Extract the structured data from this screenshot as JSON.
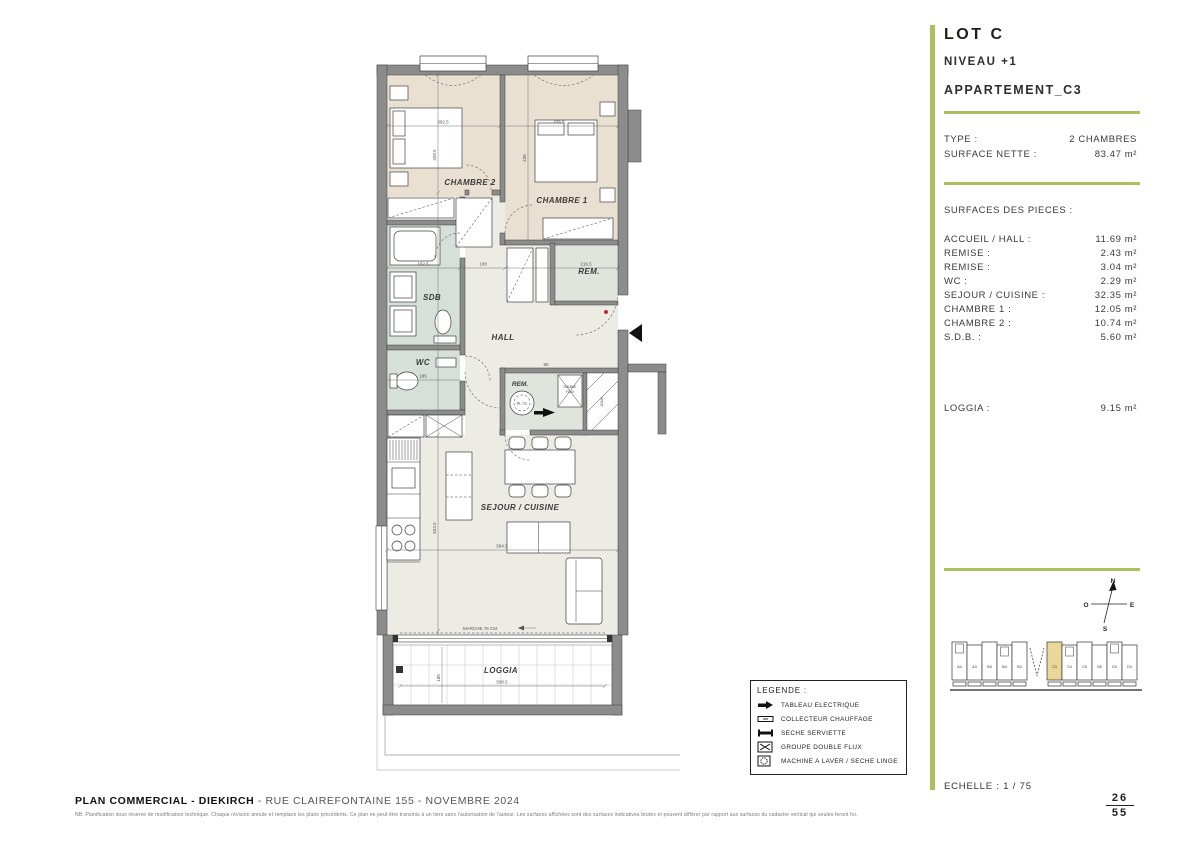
{
  "header": {
    "lot": "LOT C",
    "niveau": "NIVEAU +1",
    "apartment": "APPARTEMENT_C3"
  },
  "summary": {
    "type_label": "TYPE :",
    "type_value": "2 CHAMBRES",
    "surface_label": "SURFACE NETTE :",
    "surface_value": "83.47 m²",
    "pieces_header": "SURFACES DES PIECES :"
  },
  "rooms": [
    {
      "label": "ACCUEIL / HALL :",
      "value": "11.69 m²"
    },
    {
      "label": "REMISE :",
      "value": "2.43 m²"
    },
    {
      "label": "REMISE :",
      "value": "3.04 m²"
    },
    {
      "label": "WC :",
      "value": "2.29 m²"
    },
    {
      "label": "SEJOUR / CUISINE :",
      "value": "32.35 m²"
    },
    {
      "label": "CHAMBRE 1 :",
      "value": "12.05 m²"
    },
    {
      "label": "CHAMBRE 2 :",
      "value": "10.74 m²"
    },
    {
      "label": "S.D.B. :",
      "value": "5.60 m²"
    }
  ],
  "loggia_row": {
    "label": "LOGGIA :",
    "value": "9.15 m²"
  },
  "scale": "ECHELLE : 1 / 75",
  "page": {
    "current": "26",
    "total": "55"
  },
  "plan": {
    "labels": {
      "chambre2": "CHAMBRE 2",
      "chambre1": "CHAMBRE 1",
      "sdb": "SDB",
      "wc": "WC",
      "hall": "HALL",
      "rem1": "REM.",
      "rem2": "REM.",
      "sejour": "SEJOUR / CUISINE",
      "loggia": "LOGGIA",
      "marche": "MARCHE 76 CM",
      "ml": "ML / SL",
      "df1": "DOUBLE",
      "df2": "FLUX",
      "shaft": "40/126"
    },
    "dims": {
      "chambre2_w": "302.5",
      "chambre1_w": "276.5",
      "chambre2_h": "328.5",
      "chambre1_h": "436",
      "sdb_w": "182.5",
      "hall_w": "108",
      "rem1_w": "216.5",
      "wc_w": "185",
      "rem2_w": "95",
      "sejour_h": "553.5",
      "sejour_w": "584.5",
      "loggia_w": "508.5",
      "loggia_h": "180"
    }
  },
  "legend": {
    "title": "LEGENDE :",
    "items": [
      {
        "icon": "tableau-electrique-icon",
        "label": "TABLEAU ELECTRIQUE"
      },
      {
        "icon": "collecteur-chauffage-icon",
        "label": "COLLECTEUR CHAUFFAGE"
      },
      {
        "icon": "seche-serviette-icon",
        "label": "SECHE SERVIETTE"
      },
      {
        "icon": "groupe-double-flux-icon",
        "label": "GROUPE DOUBLE FLUX"
      },
      {
        "icon": "machine-a-laver-icon",
        "label": "MACHINE A LAVER / SECHE LINGE"
      }
    ]
  },
  "compass": {
    "n": "N",
    "e": "E",
    "s": "S",
    "o": "O"
  },
  "position_diagram": {
    "units": [
      "A4",
      "A3",
      "B5",
      "B4",
      "B3",
      "C3",
      "C4",
      "C5",
      "D5",
      "D4",
      "D3"
    ],
    "highlighted": "C3"
  },
  "footer": {
    "title_bold": "PLAN COMMERCIAL - DIEKIRCH",
    "title_rest": " - RUE CLAIREFONTAINE 155 - NOVEMBRE 2024",
    "disclaimer": "NB: Planification sous réserve de modification technique. Chaque révision annule et remplace les plans précédents. Ce plan ne peut être transmis à un tiers sans l'autorisation de l'auteur. Les surfaces affichées sont des surfaces indicatives brutes et peuvent différer par rapport aux surfaces du cadastre vertical qui seules feront foi."
  },
  "colors": {
    "accent": "#a9c05e",
    "highlight_unit": "#e9d79c",
    "wall": "#8c8c8c",
    "floor_bedroom": "#e9e0d1",
    "floor_wet": "#d6e0d8",
    "floor_main": "#ecebe4"
  }
}
